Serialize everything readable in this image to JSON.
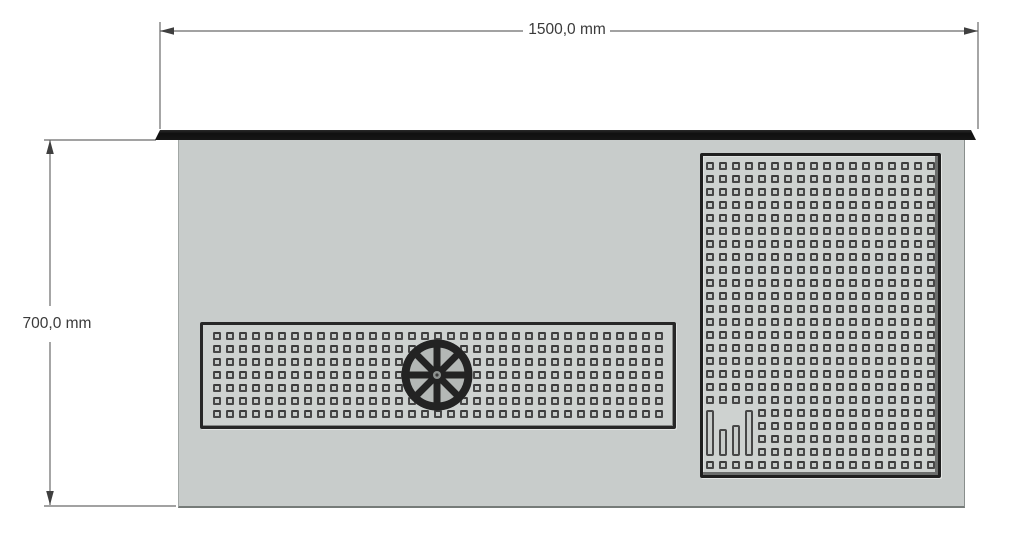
{
  "drawing": {
    "kind": "worktop technical drawing, top view",
    "dimensions": {
      "width": {
        "label": "1500,0 mm",
        "value_mm": 1500.0
      },
      "height": {
        "label": "700,0 mm",
        "value_mm": 700.0
      }
    },
    "colors": {
      "background": "#ffffff",
      "body_face": "#c8cccb",
      "panel_face": "#ced2d0",
      "dark_trim": "#161616",
      "hole_outline": "#474747",
      "dimension_line": "#6a6a6a",
      "dimension_text": "#3a3a3a"
    },
    "worktop": {
      "splash_edge_strip": {
        "position": "top edge"
      },
      "drip_tray": {
        "hole_cols": 35,
        "hole_rows": 7
      },
      "drain_rosette": {
        "spokes": 8
      },
      "vent_panel": {
        "hole_cols": 18,
        "hole_rows": 24,
        "slot_area": {
          "col_start": 0,
          "col_end": 3,
          "row_start": 19,
          "row_end": 22
        },
        "slot_heights": [
          46,
          27,
          31,
          46
        ]
      }
    }
  }
}
